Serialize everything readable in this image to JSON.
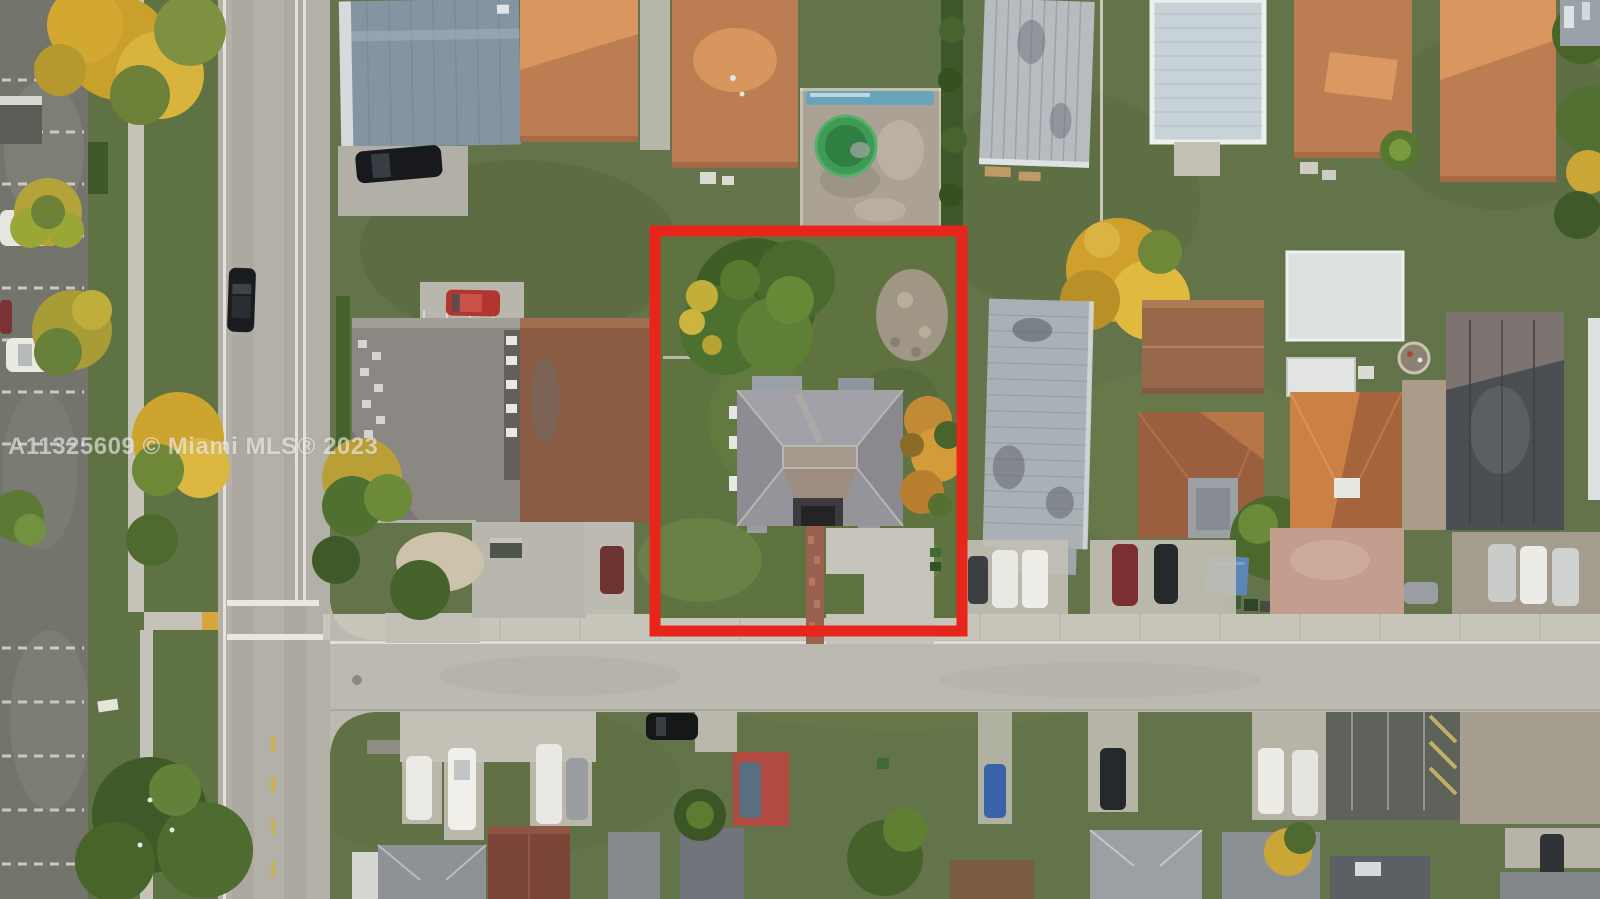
{
  "scene": {
    "kind": "aerial-drone-photograph",
    "description": "Overhead view of a suburban residential block. A red rectangle outlines the subject lot containing a gray hip-roof house, a brick front walkway, a concrete driveway, a large green shade tree and a golden tree. A street runs vertically on the west and another horizontally on the south, with parked cars, lawns, palms and terracotta, metal and shingle roofs of neighboring homes all around.",
    "highlighted_lot_features": [
      "gray hip-roof single-story house",
      "large green shade tree",
      "golden tree on east side",
      "brick front walkway",
      "L-shaped concrete driveway",
      "open green lawn",
      "bare dirt patch in rear corner"
    ]
  },
  "watermark": {
    "text": "A11325609 © Miami MLS® 2023"
  },
  "annotation": {
    "label": "property-boundary",
    "color": "#e8251a"
  },
  "colors": {
    "boundary_red": "#e8251a",
    "watermark_white": "rgba(255,255,255,0.55)",
    "lawn_green": "#5e7340",
    "road_gray": "#b3b0a7",
    "sidewalk_gray": "#c8c5ba",
    "subject_roof_gray": "#95949a",
    "terracotta_roof": "#bd7d52",
    "metal_roof_silver": "#b7bcc0",
    "tree_green": "#4c682c",
    "tree_gold": "#d2a52e"
  }
}
